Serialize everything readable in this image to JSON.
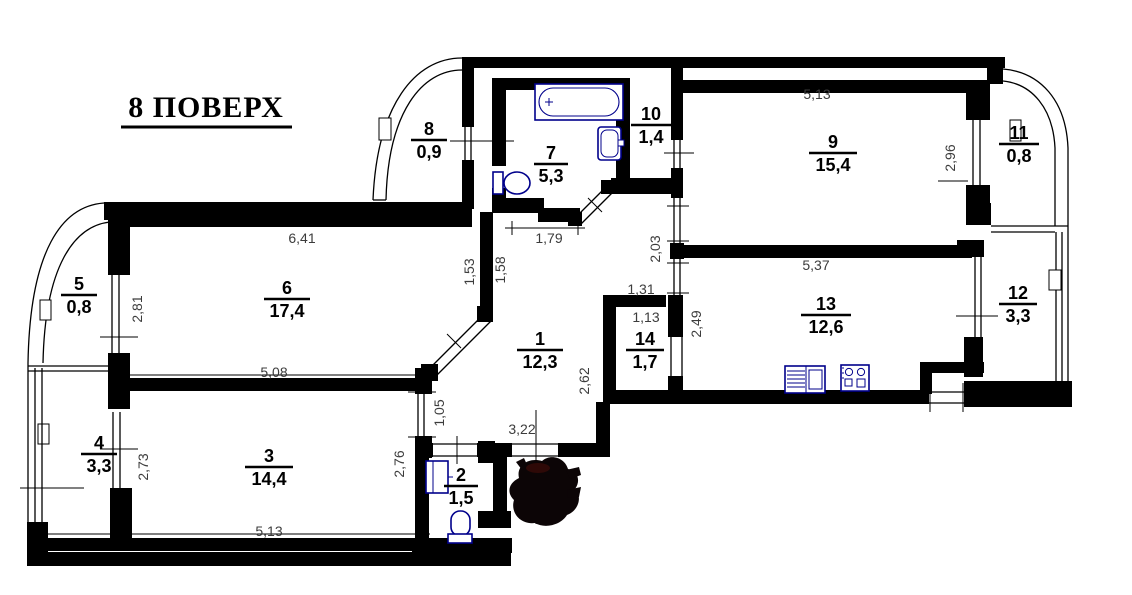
{
  "title": "8 ПОВЕРХ",
  "rooms": [
    {
      "number": "1",
      "area": "12,3"
    },
    {
      "number": "2",
      "area": "1,5"
    },
    {
      "number": "3",
      "area": "14,4"
    },
    {
      "number": "4",
      "area": "3,3"
    },
    {
      "number": "5",
      "area": "0,8"
    },
    {
      "number": "6",
      "area": "17,4"
    },
    {
      "number": "7",
      "area": "5,3"
    },
    {
      "number": "8",
      "area": "0,9"
    },
    {
      "number": "9",
      "area": "15,4"
    },
    {
      "number": "10",
      "area": "1,4"
    },
    {
      "number": "11",
      "area": "0,8"
    },
    {
      "number": "12",
      "area": "3,3"
    },
    {
      "number": "13",
      "area": "12,6"
    },
    {
      "number": "14",
      "area": "1,7"
    }
  ],
  "dimensions": [
    {
      "value": "6,41"
    },
    {
      "value": "1,79"
    },
    {
      "value": "5,13"
    },
    {
      "value": "2,96"
    },
    {
      "value": "1,53"
    },
    {
      "value": "1,58"
    },
    {
      "value": "2,81"
    },
    {
      "value": "2,03"
    },
    {
      "value": "5,37"
    },
    {
      "value": "1,31"
    },
    {
      "value": "1,13"
    },
    {
      "value": "2,49"
    },
    {
      "value": "5,08"
    },
    {
      "value": "2,62"
    },
    {
      "value": "1,05"
    },
    {
      "value": "3,22"
    },
    {
      "value": "2,73"
    },
    {
      "value": "2,76"
    },
    {
      "value": "5,13"
    }
  ],
  "fixtures": [
    "bathtub",
    "bath-wash-basin",
    "bath-toilet",
    "wc-wash-basin",
    "wc-toilet",
    "kitchen-counter-sink",
    "kitchen-stove"
  ],
  "marks": [
    "ink-stamp"
  ],
  "colors": {
    "walls": "#000000",
    "fixtures": "#00008b",
    "dimension_text": "#3c3c3c",
    "stamp": "#0c0506"
  }
}
